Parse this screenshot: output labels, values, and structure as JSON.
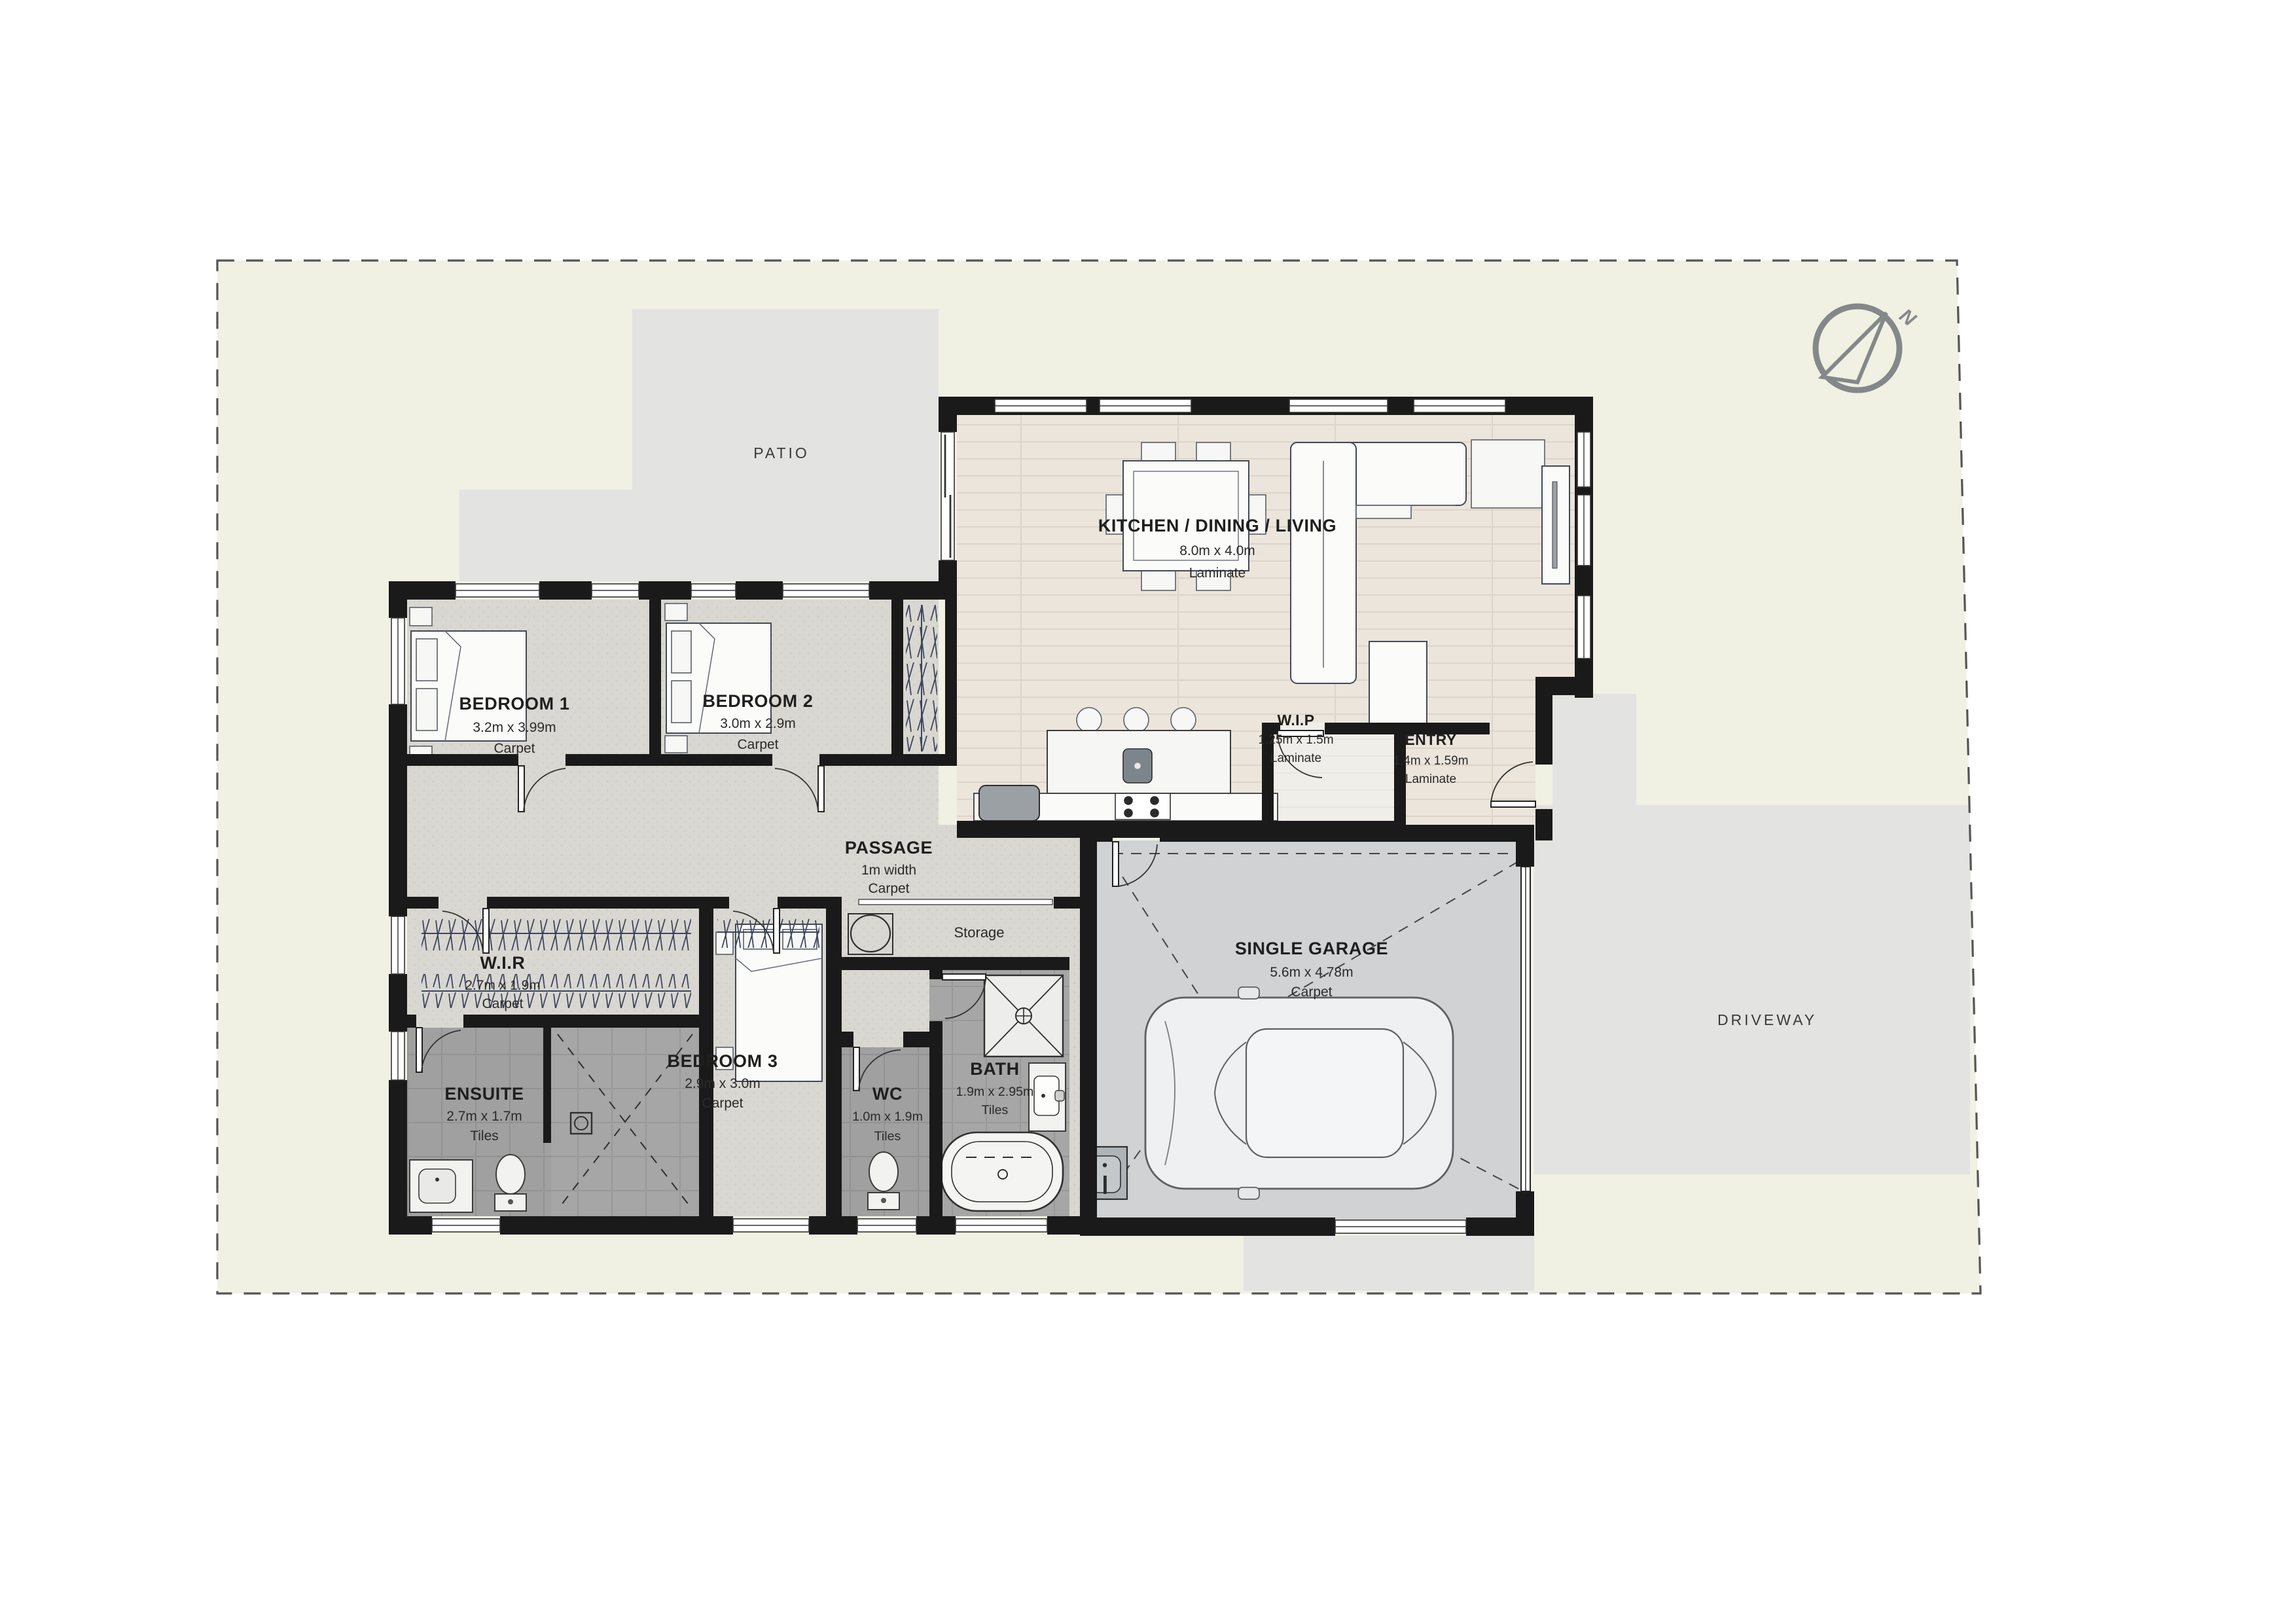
{
  "site": {
    "patio_label": "PATIO",
    "driveway_label": "DRIVEWAY",
    "north_label": "N"
  },
  "rooms": {
    "kitchen": {
      "name": "KITCHEN / DINING / LIVING",
      "dims": "8.0m x 4.0m",
      "floor": "Laminate"
    },
    "wip": {
      "name": "W.I.P",
      "dims": "1.25m x 1.5m",
      "floor": "Laminate"
    },
    "entry": {
      "name": "ENTRY",
      "dims": "1.4m x 1.59m",
      "floor": "Laminate"
    },
    "bedroom1": {
      "name": "BEDROOM 1",
      "dims": "3.2m x 3.99m",
      "floor": "Carpet"
    },
    "bedroom2": {
      "name": "BEDROOM 2",
      "dims": "3.0m x 2.9m",
      "floor": "Carpet"
    },
    "bedroom3": {
      "name": "BEDROOM 3",
      "dims": "2.9m x 3.0m",
      "floor": "Carpet"
    },
    "passage": {
      "name": "PASSAGE",
      "dims": "1m width",
      "floor": "Carpet"
    },
    "wir": {
      "name": "W.I.R",
      "dims": "2.7m x 1.9m",
      "floor": "Carpet"
    },
    "ensuite": {
      "name": "ENSUITE",
      "dims": "2.7m x 1.7m",
      "floor": "Tiles"
    },
    "wc": {
      "name": "WC",
      "dims": "1.0m x 1.9m",
      "floor": "Tiles"
    },
    "bath": {
      "name": "BATH",
      "dims": "1.9m x 2.95m",
      "floor": "Tiles"
    },
    "garage": {
      "name": "SINGLE GARAGE",
      "dims": "5.6m x 4.78m",
      "floor": "Carpet"
    },
    "storage": {
      "name": "Storage"
    }
  },
  "colors": {
    "wall": "#1a1a1a",
    "site": "#f0f1e3",
    "paving": "#e3e3e1",
    "carpet": "#d9d7d1",
    "laminate": "#ebe5dc",
    "tiles": "#a6a6a6",
    "garage_floor": "#d0d2d4",
    "compass": "#85888a"
  }
}
